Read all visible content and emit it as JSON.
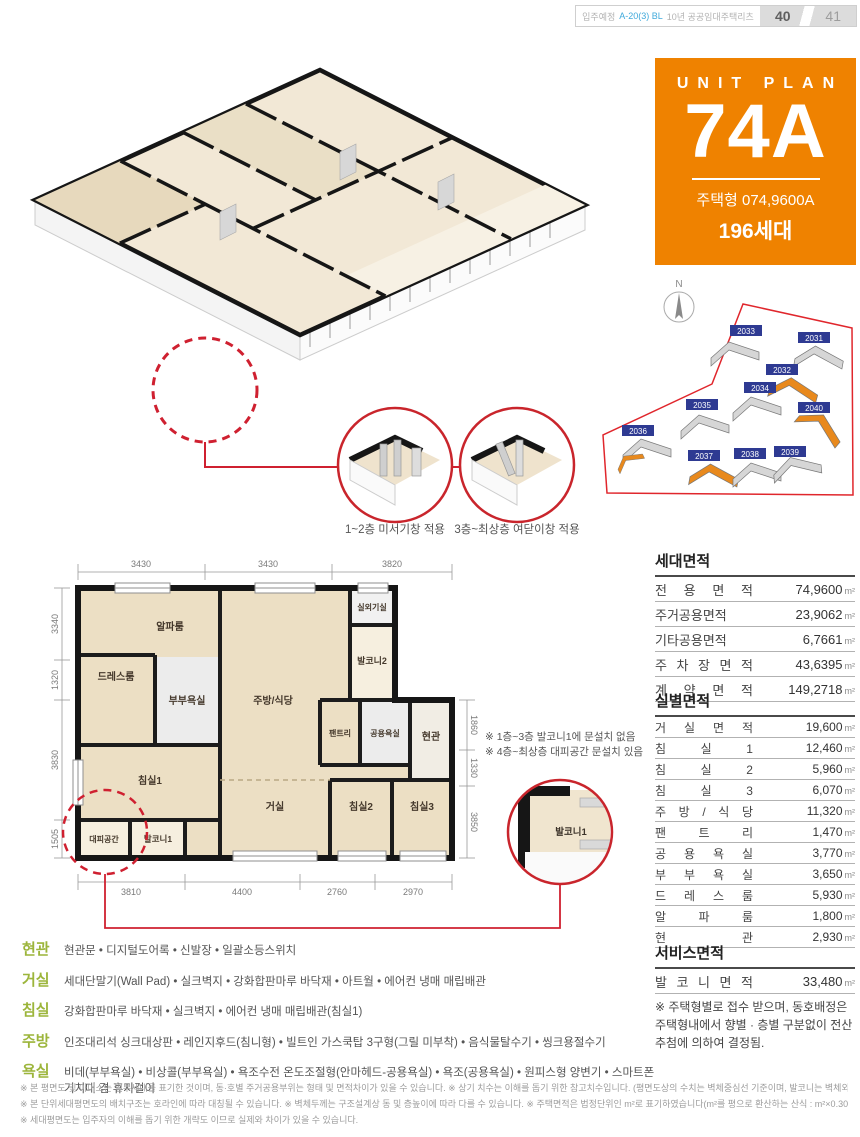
{
  "colors": {
    "accent_orange": "#ef8200",
    "label_green": "#9cb53b",
    "red": "#cf2030",
    "navy": "#2e3a92"
  },
  "header": {
    "prefix": "입주예정",
    "highlight": "A-20(3) BL",
    "suffix": "10년 공공임대주택리츠",
    "page_left": "40",
    "page_right": "41"
  },
  "unit_box": {
    "title": "UNIT PLAN",
    "code": "74A",
    "type": "주택형 074,9600A",
    "households": "196세대"
  },
  "window_callouts": {
    "left": "1~2층 미서기창 적용",
    "right": "3층~최상층 여닫이창 적용"
  },
  "site_plan": {
    "compass": "N",
    "buildings": [
      {
        "id": "2033"
      },
      {
        "id": "2031"
      },
      {
        "id": "2032",
        "highlighted": true
      },
      {
        "id": "2034"
      },
      {
        "id": "2035"
      },
      {
        "id": "2036",
        "highlighted": true
      },
      {
        "id": "2040",
        "highlighted": true
      },
      {
        "id": "2037",
        "highlighted": true
      },
      {
        "id": "2038"
      },
      {
        "id": "2039"
      }
    ]
  },
  "plan2d": {
    "rooms": {
      "alpha": "알파룸",
      "dress": "드레스룸",
      "master_bath": "부부욕실",
      "kitchen": "주방/식당",
      "outdoor_unit": "실외기실",
      "balcony2": "발코니2",
      "pantry": "팬트리",
      "common_bath": "공용욕실",
      "entry": "현관",
      "bed1": "침실1",
      "living": "거실",
      "bed2": "침실2",
      "bed3": "침실3",
      "refuge": "대피공간",
      "balcony1": "발코니1"
    },
    "dims_top": [
      "3430",
      "3430",
      "3820"
    ],
    "dims_bottom": [
      "3810",
      "4400",
      "2760",
      "2970"
    ],
    "dims_left": [
      "3340",
      "1320",
      "3830",
      "1505"
    ],
    "dims_right": [
      "1860",
      "1330",
      "3850"
    ],
    "notes": [
      "※ 1층~3층 발코니1에 문설치 없음",
      "※ 4층~최상층 대피공간 문설치 있음"
    ],
    "detail_label": "발코니1"
  },
  "tables": {
    "unit_area": {
      "title": "세대면적",
      "rows": [
        {
          "label": "전 용 면 적",
          "value": "74,9600",
          "unit": "m²"
        },
        {
          "label": "주거공용면적",
          "value": "23,9062",
          "unit": "m²"
        },
        {
          "label": "기타공용면적",
          "value": "6,7661",
          "unit": "m²"
        },
        {
          "label": "주 차 장 면 적",
          "value": "43,6395",
          "unit": "m²"
        },
        {
          "label": "계 약 면 적",
          "value": "149,2718",
          "unit": "m²"
        }
      ]
    },
    "room_area": {
      "title": "실별면적",
      "rows": [
        {
          "label": "거 실 면 적",
          "value": "19,600",
          "unit": "m²"
        },
        {
          "label": "침 실 1",
          "value": "12,460",
          "unit": "m²"
        },
        {
          "label": "침 실 2",
          "value": "5,960",
          "unit": "m²"
        },
        {
          "label": "침 실 3",
          "value": "6,070",
          "unit": "m²"
        },
        {
          "label": "주 방 / 식 당",
          "value": "11,320",
          "unit": "m²"
        },
        {
          "label": "팬 트 리",
          "value": "1,470",
          "unit": "m²"
        },
        {
          "label": "공 용 욕 실",
          "value": "3,770",
          "unit": "m²"
        },
        {
          "label": "부 부 욕 실",
          "value": "3,650",
          "unit": "m²"
        },
        {
          "label": "드 레 스 룸",
          "value": "5,930",
          "unit": "m²"
        },
        {
          "label": "알 파 룸",
          "value": "1,800",
          "unit": "m²"
        },
        {
          "label": "현 관",
          "value": "2,930",
          "unit": "m²"
        }
      ]
    },
    "service_area": {
      "title": "서비스면적",
      "rows": [
        {
          "label": "발 코 니 면 적",
          "value": "33,480",
          "unit": "m²"
        }
      ]
    },
    "note": "※ 주택형별로 접수 받으며, 동호배정은 주택형내에서 향별 · 층별 구분없이 전산추첨에 의하여 결정됨."
  },
  "specs": [
    {
      "label": "현관",
      "text": "현관문 • 디지털도어록 • 신발장 • 일괄소등스위치"
    },
    {
      "label": "거실",
      "text": "세대단말기(Wall Pad) • 실크벽지 • 강화합판마루 바닥재 • 아트월 • 에어컨 냉매 매립배관"
    },
    {
      "label": "침실",
      "text": "강화합판마루 바닥재 • 실크벽지 • 에어컨 냉매 매립배관(침실1)"
    },
    {
      "label": "주방",
      "text": "인조대리석 싱크대상판 • 레인지후드(침니형) • 빌트인 가스쿡탑 3구형(그릴 미부착) • 음식물탈수기 • 씽크용절수기"
    },
    {
      "label": "욕실",
      "text": "비데(부부욕실) • 비상콜(부부욕실) • 욕조수전 온도조절형(안마헤드-공용욕실) • 욕조(공용욕실) • 원피스형 양변기 • 스마트폰 거치대 겸 휴지걸이"
    }
  ],
  "footnotes": [
    "※ 본 평면도 및 아이소는 일부세대를 표기한 것이며, 동·호별 주거공용부위는 형태 및 면적차이가 있을 수 있습니다.   ※ 상기 치수는 이해를 돕기 위한 참고치수입니다. (평면도상의 수치는 벽체중심선 기준이며, 발코니는 벽체외부끝선 기준임)",
    "※ 본 단위세대평면도의 배치구조는 호라인에 따라 대칭될 수 있습니다.   ※ 벽체두께는 구조설계상 동 및 층높이에 따라 다를 수 있습니다.   ※ 주택면적은 법정단위인 m²로 표기하였습니다(m²를 평으로 환산하는 산식 : m²×0.3025=평)",
    "※ 세대평면도는 입주자의 이해를 돕기 위한 개략도 이므로 실제와 차이가 있을 수 있습니다."
  ]
}
